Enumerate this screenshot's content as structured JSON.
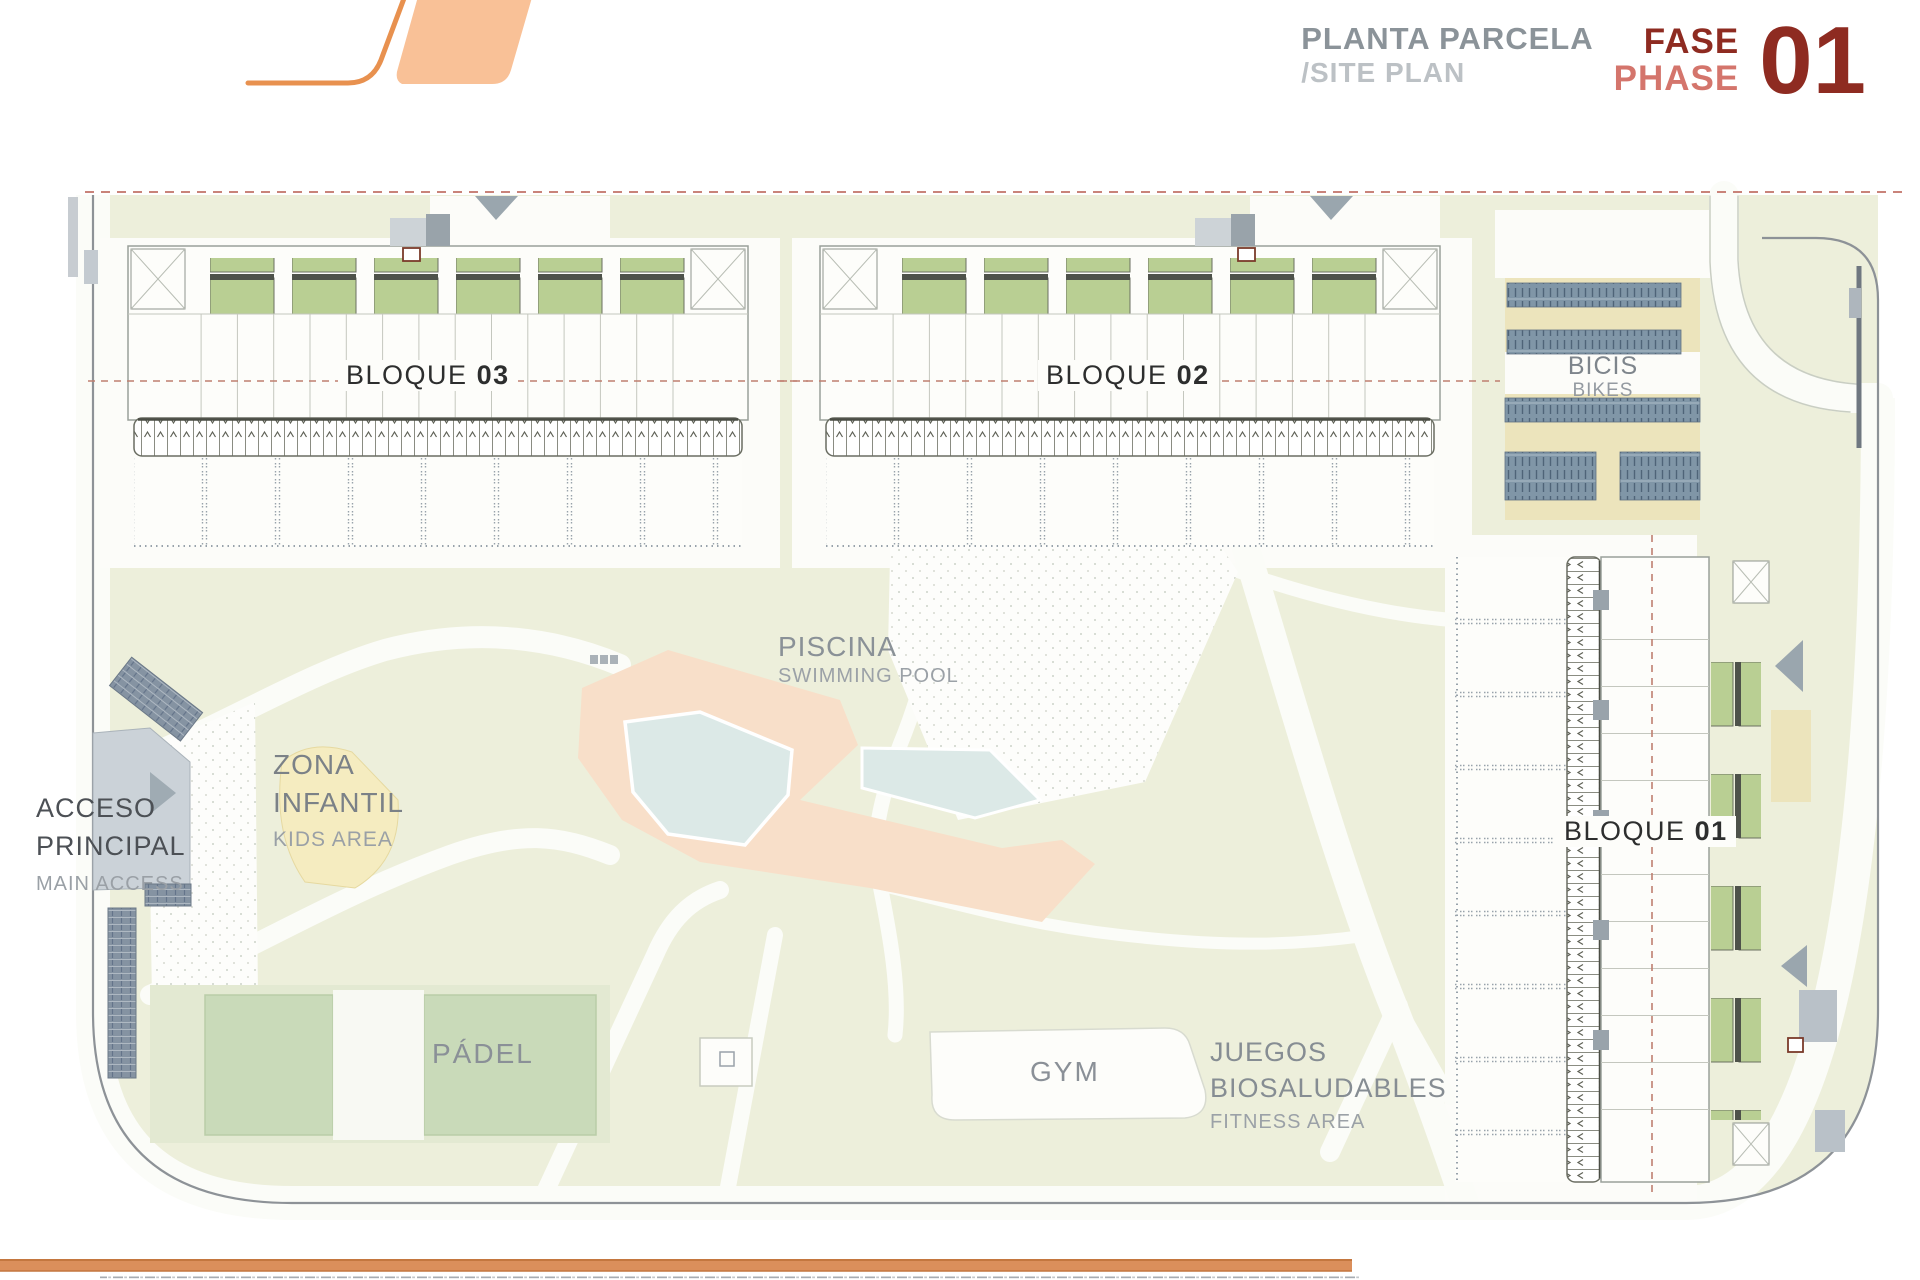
{
  "header": {
    "title_primary": "PLANTA PARCELA",
    "title_secondary": "/SITE PLAN",
    "phase_primary": "FASE",
    "phase_secondary": "PHASE",
    "phase_number": "01"
  },
  "site": {
    "blocks": [
      {
        "label": "BLOQUE",
        "number": "03"
      },
      {
        "label": "BLOQUE",
        "number": "02"
      },
      {
        "label": "BLOQUE",
        "number": "01"
      }
    ],
    "areas": {
      "bikes": {
        "primary": "BICIS",
        "secondary": "BIKES"
      },
      "pool": {
        "primary": "PISCINA",
        "secondary": "SWIMMING POOL"
      },
      "kids": {
        "primary_line1": "ZONA",
        "primary_line2": "INFANTIL",
        "secondary": "KIDS AREA"
      },
      "access": {
        "primary_line1": "ACCESO",
        "primary_line2": "PRINCIPAL",
        "secondary": "MAIN ACCESS"
      },
      "padel": {
        "primary": "PÁDEL"
      },
      "gym": {
        "primary": "GYM"
      },
      "fitness": {
        "primary_line1": "JUEGOS",
        "primary_line2": "BIOSALUDABLES",
        "secondary": "FITNESS AREA"
      }
    }
  },
  "colors": {
    "accent_orange": "#e8914f",
    "logo_fill": "#f9c197",
    "phase_dark": "#8e2b21",
    "phase_light": "#d4756c",
    "title_gray": "#8b9399",
    "title_light_gray": "#bcc1c5",
    "parcel_green": "#edefdb",
    "unit_green": "#b9cf93",
    "pool_blue": "#dce9e7",
    "deck_salmon": "#f8dfc9",
    "kids_yellow": "#f5ecc0",
    "bike_rack_blue": "#8096a7",
    "bike_khaki": "#ece4bc"
  }
}
